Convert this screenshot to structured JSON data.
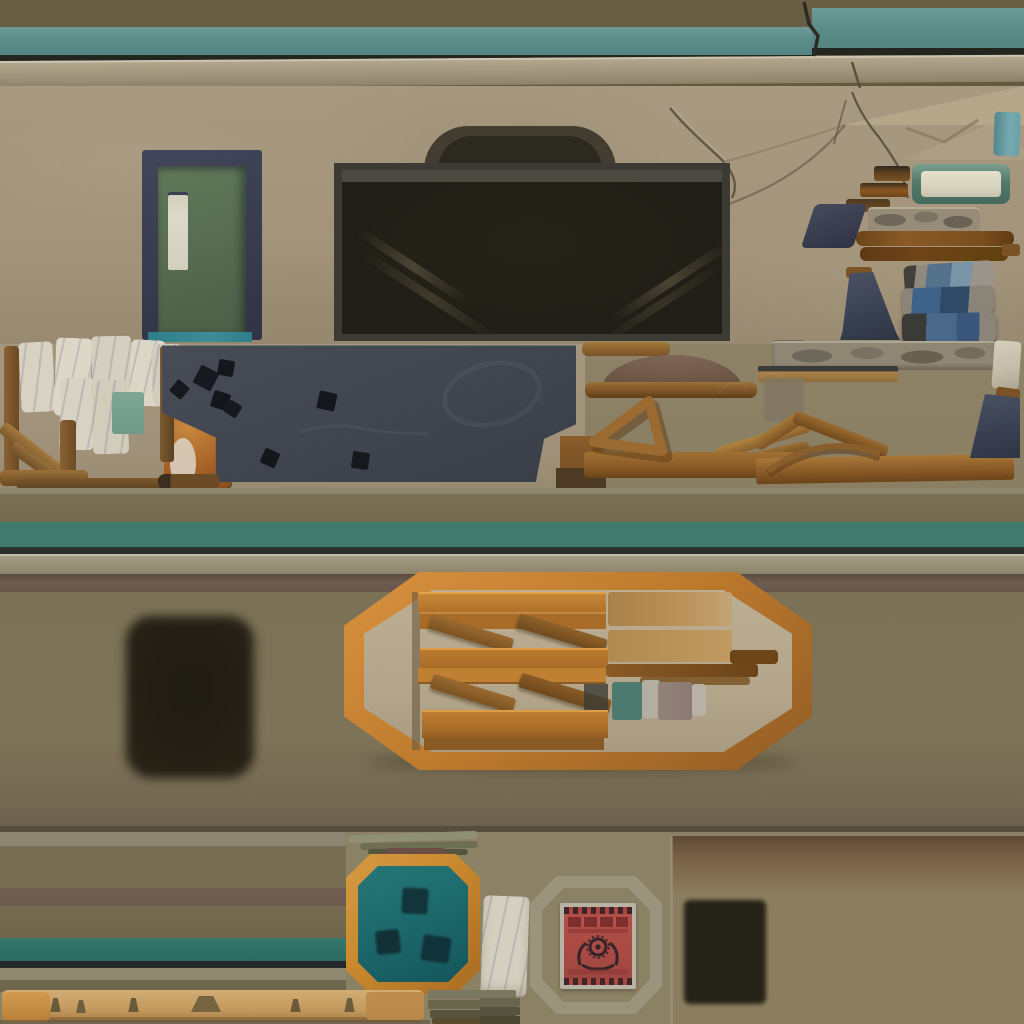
{
  "meta": {
    "kind": "hand-painted game environment texture atlas",
    "canvas_size": "1024x1024",
    "text_content": "none (image contains no legible text)"
  },
  "palette": {
    "trim_olive": "#6a5f44",
    "trim_teal": "#5d8d89",
    "khaki_strip": "#a99e86",
    "wall_tan": "#a3947b",
    "door_green": "#5a7153",
    "door_frame_navy": "#383c4e",
    "door_threshold_teal": "#2e7d8a",
    "garage_dark": "#24221a",
    "wood_orange": "#c07c2e",
    "wood_brown": "#8a5a26",
    "wood_dark": "#6b4418",
    "slate_board": "#41454f",
    "board_hole_black": "#17191f",
    "stripe_teal": "#3f7a6c",
    "stripe_dark": "#24282b",
    "mauve_band": "#6e5c50",
    "lower_olive": "#7d7358",
    "pallet_inner_tan": "#b3a68b",
    "panel_teal": "#1d6a6c",
    "poster_red": "#b0544c",
    "poster_border": "#b7b2a4",
    "emblem_dark": "#35232a",
    "burn_blob_dark": "#201d13",
    "stone_gray": "#8f8674",
    "fabric_blue": "#3f628a",
    "paper_white": "#d8d2c2",
    "note_teal": "#7ca595",
    "cat_orange": "#b06a2c"
  },
  "regions": {
    "top_trim": "upper wall trim: olive band, teal stripe, cracked offset, khaki ledge",
    "wall": "tan plaster wall with cracks and diagonal broken corner",
    "door": "green service door with dark navy frame and narrow window",
    "garage_opening": "large dark doorway opening with arched shadow above",
    "right_props": "small props: teal tab, green-rimmed box, step trim, navy wedge, stone bar, brown rails, folded blue fabric stack",
    "notes_wall": "cluster of pinned white notes and one teal note",
    "railing": "wooden stair railing with diagonal rails",
    "cat": "orange cat texture peeking behind board",
    "chalkboard": "dark slate board with punched square holes and faint chalk marks",
    "awning_props": "brown dome awning on plank, wooden easel triangle, crossed sticks, planks",
    "masonry": "stone masonry strip with light end block",
    "gable": "wooden roof gable with curved arch brace",
    "mid_trim": "middle trim: olive band, teal stripe, dark line, khaki ledge, mauve shadow band",
    "pallet_frame": "large orange octagonal frame holding wooden slats, tan blocks and color chips",
    "burn_blob": "soft dark scorch blob",
    "lower_wall": "olive lower wall section",
    "stripe_panel": "bottom-left layered stripe panel with teal band",
    "teal_hatch": "orange octagonal frame with teal hatch and three dark holes",
    "paper_scrap": "small white scribbled paper scrap",
    "poster": "red poster with dark gear emblem and white border inside faint octagon outline",
    "dark_vent": "dark square vent opening on tan panel",
    "peg_plank": "light wooden plank with small dark pegs",
    "plank_stack": "stack of olive-green planks"
  }
}
